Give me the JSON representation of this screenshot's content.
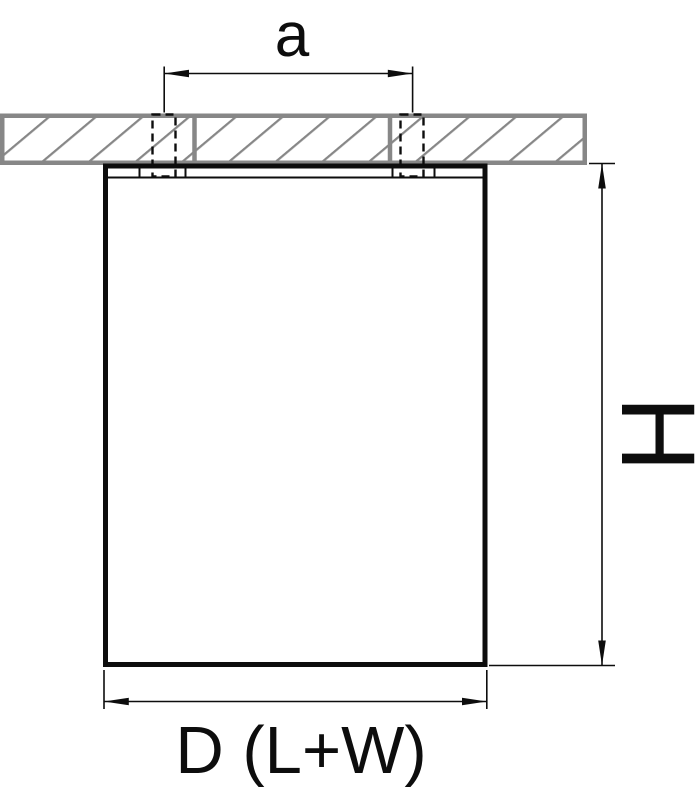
{
  "canvas": {
    "width": 699,
    "height": 800
  },
  "colors": {
    "line": "#0d0d0d",
    "ceiling": "#878787",
    "paper": "#ffffff"
  },
  "drawing": {
    "kind": "technical dimension drawing",
    "subject": "surface-mounted ceiling fixture, side section view",
    "parts": {
      "ceiling": "hatched ceiling slab section",
      "fixture": "rectangular fixture body flush under ceiling",
      "screws": "two dashed mounting screw positions through ceiling"
    }
  },
  "dimensions": {
    "spacing": {
      "label": "a",
      "orientation": "horizontal",
      "measures": "distance between mounting screw centers"
    },
    "height": {
      "label": "H",
      "orientation": "vertical",
      "measures": "overall fixture height",
      "label_rotated_deg": 90
    },
    "width": {
      "label": "D (L+W)",
      "orientation": "horizontal",
      "measures": "fixture overall width / diameter"
    }
  }
}
